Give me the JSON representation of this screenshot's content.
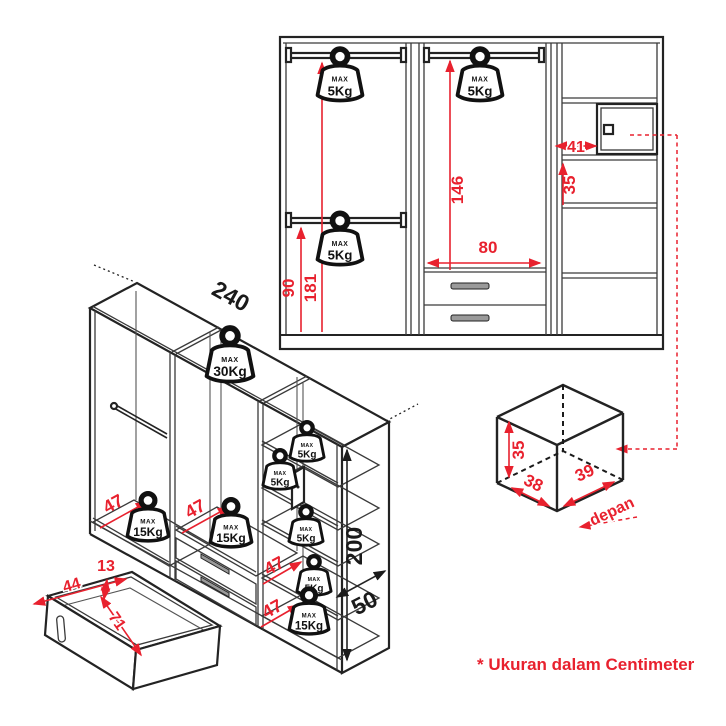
{
  "footnote": "* Ukuran dalam Centimeter",
  "weights": {
    "max_label": "MAX",
    "kg5": "5Kg",
    "kg15": "15Kg",
    "kg30": "30Kg"
  },
  "front_view": {
    "lower_rail_height": "90",
    "upper_rail_height": "181",
    "mid_rail_height": "146",
    "mid_section_width": "80",
    "cubby_width": "41",
    "cubby_height": "35"
  },
  "iso_view": {
    "total_width": "240",
    "total_height": "200",
    "total_depth": "50",
    "left_floor_depth": "47",
    "mid_floor_depth": "47",
    "shelf_depth_a": "47",
    "shelf_depth_b": "47"
  },
  "drawer_view": {
    "front_height": "13",
    "inner_width": "44",
    "inner_depth": "71"
  },
  "box_view": {
    "height": "35",
    "width": "38",
    "depth": "39",
    "front_label": "depan"
  },
  "colors": {
    "dimension_red": "#e8212e",
    "line_black": "#232323"
  }
}
